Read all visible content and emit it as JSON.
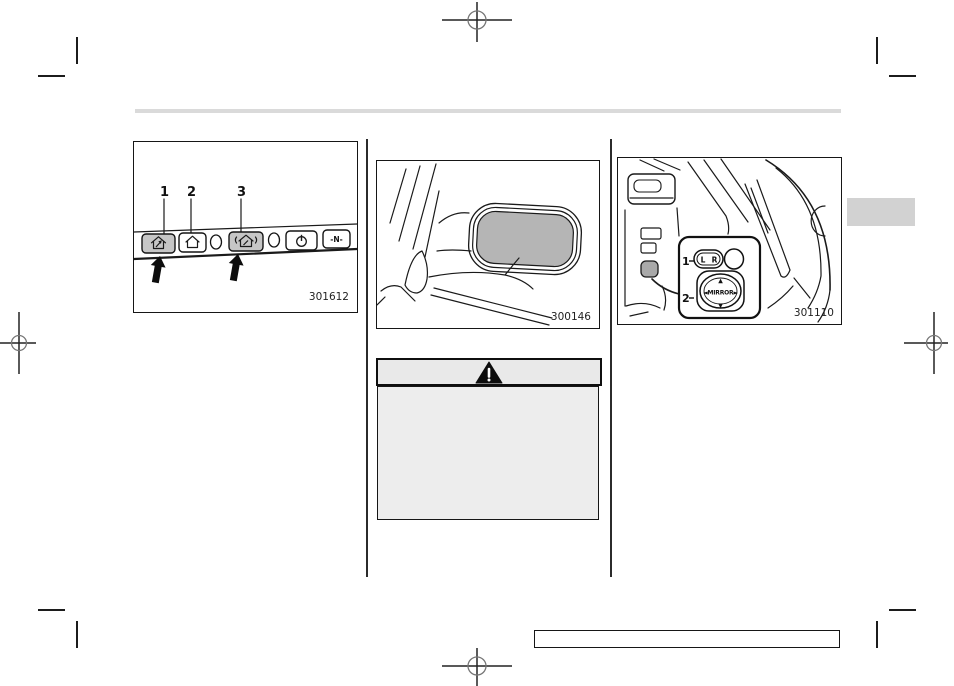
{
  "document": {
    "type": "owner-manual-page-proof"
  },
  "figures": {
    "homelink": {
      "figure_number": "301612",
      "callout_labels": [
        "1",
        "2",
        "3"
      ],
      "buttons": [
        {
          "name": "homelink-button-1",
          "icon": "house-arrow-icon",
          "shaded": true
        },
        {
          "name": "homelink-button-2",
          "icon": "house-icon",
          "shaded": false
        },
        {
          "name": "homelink-button-3",
          "icon": "house-signal-icon",
          "shaded": true
        },
        {
          "name": "power-button",
          "icon": "power-icon",
          "shaded": false
        },
        {
          "name": "compass-button",
          "icon": "compass-icon",
          "shaded": false
        }
      ],
      "compass_button_text": "-N-"
    },
    "door_mirror": {
      "figure_number": "300146"
    },
    "mirror_switch": {
      "figure_number": "301110",
      "callout_labels": [
        "1",
        "2"
      ],
      "selector_switch": {
        "left": "L",
        "right": "R"
      },
      "adjust_pad": {
        "text": "◄MIRROR►",
        "up": "▲",
        "down": "▼"
      }
    }
  },
  "warning_box": {
    "icon": "warning-triangle-icon"
  },
  "colors": {
    "page_bg": "#ffffff",
    "rule_gray": "#dadada",
    "tab_gray": "#d2d2d2",
    "mirror_glass_gray": "#b5b5b5",
    "button_shade_gray": "#c6c6c6",
    "warning_header_bg": "#e9e9e9",
    "warning_body_bg": "#ededed",
    "line_black": "#1a1a1a"
  }
}
